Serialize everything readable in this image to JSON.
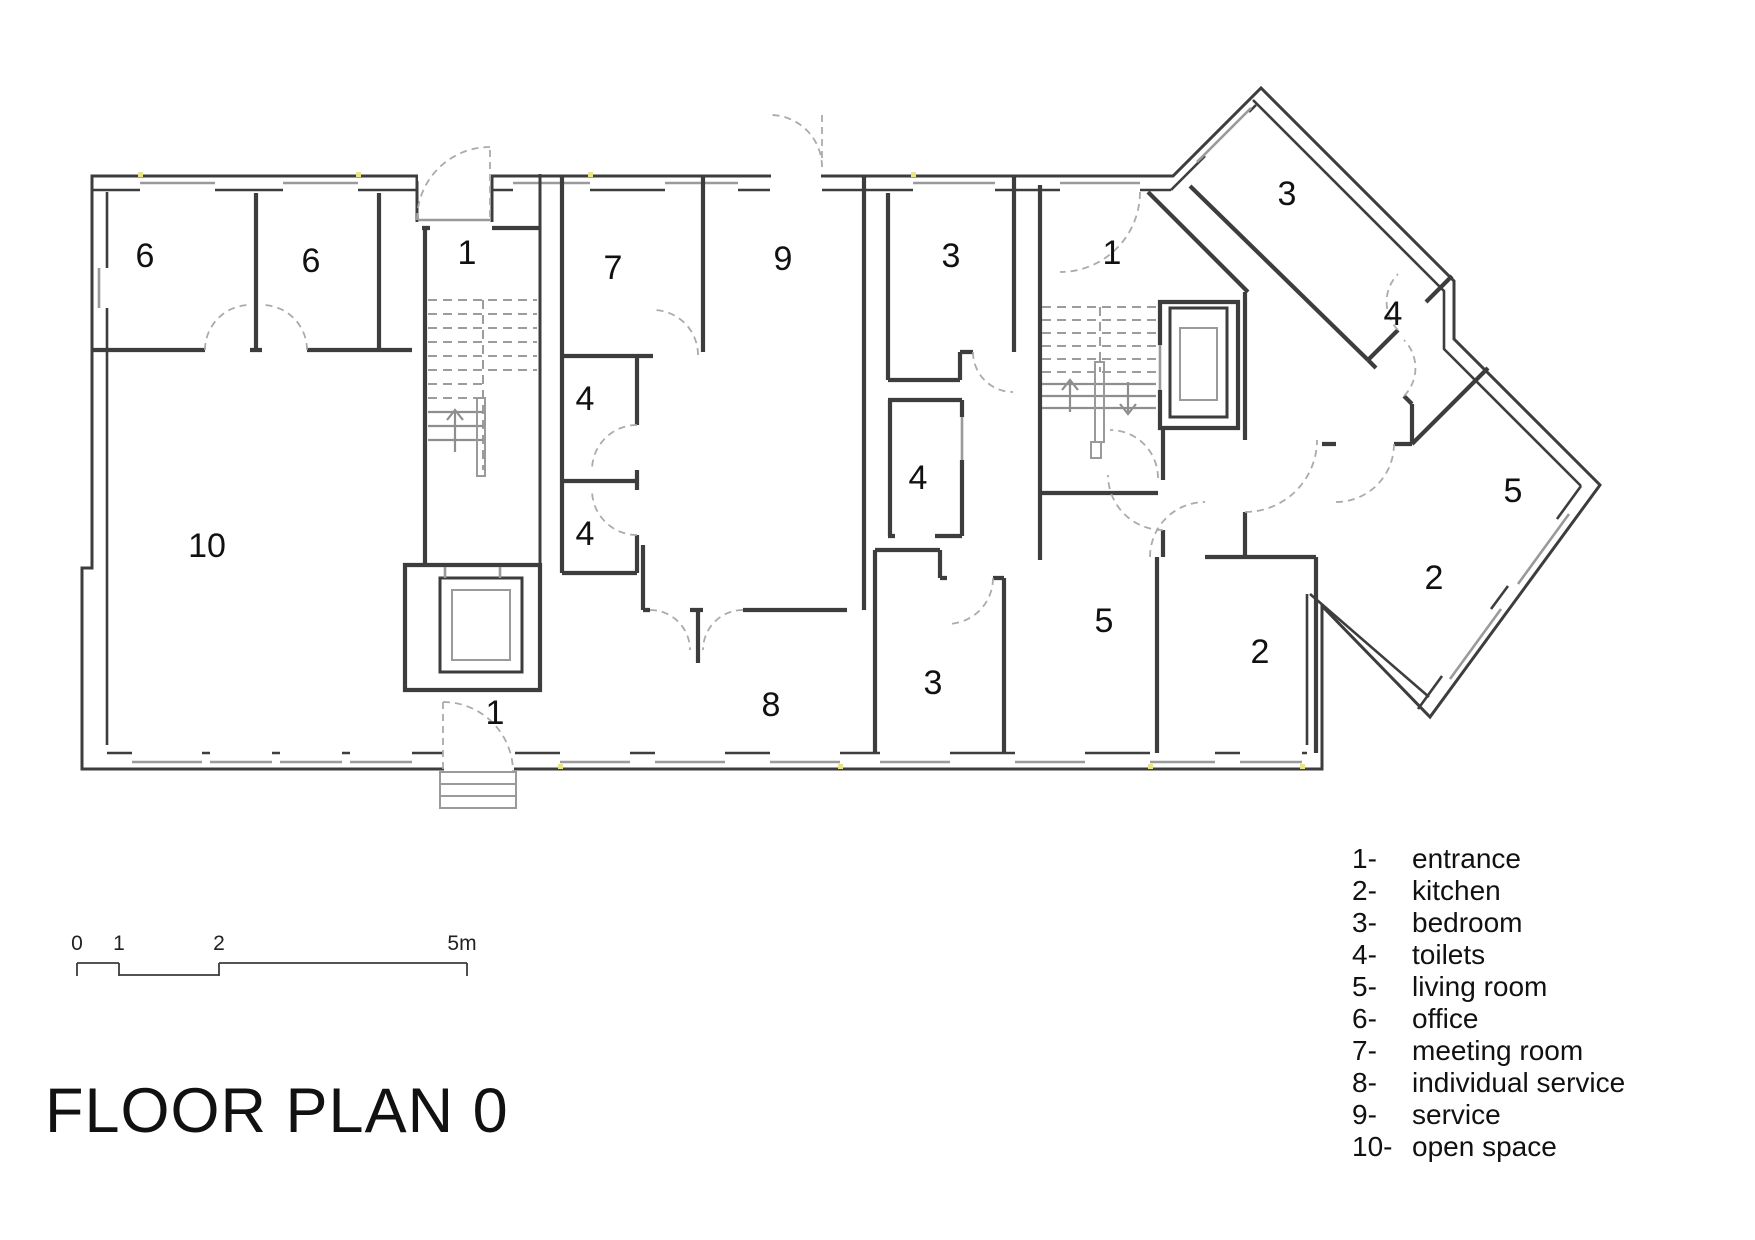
{
  "title": "FLOOR PLAN 0",
  "colors": {
    "wall": "#3d3d3d",
    "window_gray": "#9a9a9a",
    "door_dash": "#ababab",
    "jamb_highlight": "#e9e38a",
    "text": "#111111"
  },
  "scale_bar": {
    "unit": "m",
    "labels": [
      {
        "text": "0",
        "x": 77,
        "y": 950
      },
      {
        "text": "1",
        "x": 119,
        "y": 950
      },
      {
        "text": "2",
        "x": 219,
        "y": 950
      },
      {
        "text": "5m",
        "x": 462,
        "y": 950
      }
    ]
  },
  "legend": {
    "items": [
      {
        "key": "1-",
        "label": "entrance"
      },
      {
        "key": "2-",
        "label": "kitchen"
      },
      {
        "key": "3-",
        "label": "bedroom"
      },
      {
        "key": "4-",
        "label": "toilets"
      },
      {
        "key": "5-",
        "label": "living room"
      },
      {
        "key": "6-",
        "label": "office"
      },
      {
        "key": "7-",
        "label": "meeting room"
      },
      {
        "key": "8-",
        "label": "individual service"
      },
      {
        "key": "9-",
        "label": "service"
      },
      {
        "key": "10-",
        "label": "open space"
      }
    ]
  },
  "rooms": [
    {
      "number": "6",
      "name": "office",
      "x": 145,
      "y": 255
    },
    {
      "number": "6",
      "name": "office",
      "x": 311,
      "y": 260
    },
    {
      "number": "1",
      "name": "entrance",
      "x": 467,
      "y": 252
    },
    {
      "number": "7",
      "name": "meeting room",
      "x": 613,
      "y": 267
    },
    {
      "number": "9",
      "name": "service",
      "x": 783,
      "y": 258
    },
    {
      "number": "3",
      "name": "bedroom",
      "x": 951,
      "y": 255
    },
    {
      "number": "1",
      "name": "entrance",
      "x": 1112,
      "y": 252
    },
    {
      "number": "3",
      "name": "bedroom",
      "x": 1287,
      "y": 193
    },
    {
      "number": "4",
      "name": "toilets",
      "x": 1393,
      "y": 313
    },
    {
      "number": "4",
      "name": "toilets",
      "x": 585,
      "y": 398
    },
    {
      "number": "4",
      "name": "toilets",
      "x": 585,
      "y": 533
    },
    {
      "number": "4",
      "name": "toilets",
      "x": 918,
      "y": 477
    },
    {
      "number": "10",
      "name": "open space",
      "x": 207,
      "y": 545
    },
    {
      "number": "5",
      "name": "living room",
      "x": 1513,
      "y": 490
    },
    {
      "number": "2",
      "name": "kitchen",
      "x": 1434,
      "y": 577
    },
    {
      "number": "5",
      "name": "living room",
      "x": 1104,
      "y": 620
    },
    {
      "number": "2",
      "name": "kitchen",
      "x": 1260,
      "y": 651
    },
    {
      "number": "3",
      "name": "bedroom",
      "x": 933,
      "y": 682
    },
    {
      "number": "8",
      "name": "individual service",
      "x": 771,
      "y": 704
    },
    {
      "number": "1",
      "name": "entrance",
      "x": 495,
      "y": 712
    }
  ]
}
